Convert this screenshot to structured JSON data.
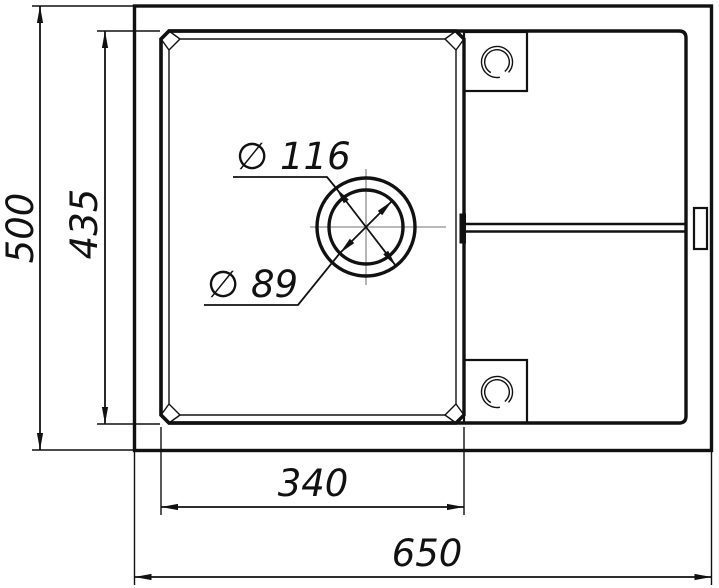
{
  "drawing": {
    "kind": "technical-drawing",
    "subject": "kitchen-sink-top-view",
    "dimension_labels": {
      "overall_width": "650",
      "overall_depth": "500",
      "bowl_width": "340",
      "bowl_depth": "435",
      "drain_flange_diameter": "∅ 116",
      "drain_hole_diameter": "∅ 89"
    },
    "colors": {
      "line": "#111111",
      "background": "#ffffff",
      "centerline": "#8f8f8f"
    }
  }
}
